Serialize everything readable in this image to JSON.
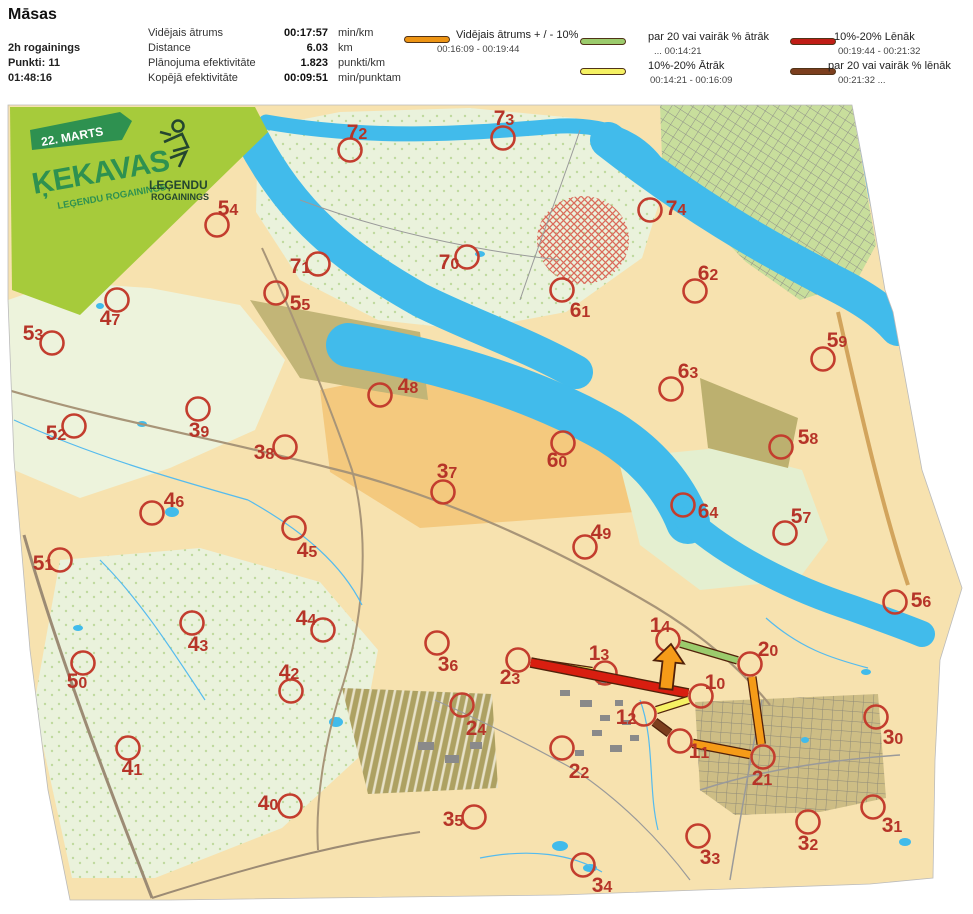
{
  "header": {
    "title": "Māsas",
    "event": "2h rogainings",
    "points": "Punkti: 11",
    "total_time": "01:48:16",
    "stats": {
      "rows": [
        {
          "label": "Vidējais ātrums",
          "value": "00:17:57",
          "unit": "min/km"
        },
        {
          "label": "Distance",
          "value": "6.03",
          "unit": "km"
        },
        {
          "label": "Plānojuma efektivitāte",
          "value": "1.823",
          "unit": "punkti/km"
        },
        {
          "label": "Kopējā efektivitāte",
          "value": "00:09:51",
          "unit": "min/punktam"
        }
      ]
    },
    "legend": {
      "entries": [
        {
          "label": "Vidējais ātrums + / - 10%",
          "range": "00:16:09   -   00:19:44",
          "color": "#ED9414"
        },
        {
          "label": "par 20 vai vairāk % ātrāk",
          "range": "...   00:14:21",
          "color": "#9BCB6C"
        },
        {
          "label": "10%-20% Ātrāk",
          "range": "00:14:21   -   00:16:09",
          "color": "#F5F163"
        },
        {
          "label": "10%-20% Lēnāk",
          "range": "00:19:44   - 00:21:32",
          "color": "#C01D16"
        },
        {
          "label": "par 20 vai vairāk % lēnāk",
          "range": "00:21:32   ...",
          "color": "#7C3E1E"
        }
      ]
    }
  },
  "banner": {
    "date": "22. MARTS",
    "title": "ĶEKAVAS",
    "subtitle": "LEĢENDU ROGAININGS",
    "logo_line1": "LEĢENDU",
    "logo_line2": "ROGAININGS",
    "bg_color": "#A6CB3B",
    "accent_color": "#2E9150",
    "logo_color": "#24462F"
  },
  "map": {
    "palette": {
      "red": "#D81E10",
      "yellow": "#F5F163",
      "orange": "#F59B18",
      "green": "#9BCB6C",
      "brown": "#7C3E1E",
      "outline": "#51210A",
      "water": "#41BBEB",
      "base": "#F7E2AF",
      "circle": "#C33D2E",
      "number": "#B63428"
    },
    "outline": "8,105 852,105 868,190 885,290 893,312 922,470 962,588 940,660 935,760 933,878 870,884 700,890 560,895 320,898 170,900 70,900 48,790 30,650 14,460 8,300",
    "regions": [
      {
        "name": "nw-green",
        "points": "8,300 60,282 150,288 240,305 285,360 255,430 170,468 80,498 14,470",
        "fill": "#EDF3DC"
      },
      {
        "name": "island",
        "points": "258,128 340,112 470,108 575,118 640,150 660,200 642,258 566,312 470,330 378,320 300,280 256,212",
        "fill": "url(#p-forest)"
      },
      {
        "name": "central-orange",
        "points": "320,390 470,360 560,388 615,425 650,470 635,512 530,520 420,528 330,472",
        "fill": "#F4C97E"
      },
      {
        "name": "sw-forest",
        "points": "60,560 200,548 320,582 378,650 358,758 282,828 155,878 72,878 34,705",
        "fill": "url(#p-forest)"
      },
      {
        "name": "se-green",
        "points": "618,458 718,448 802,470 828,540 798,580 700,590 640,545",
        "fill": "#E4EFD0"
      },
      {
        "name": "olive-1",
        "points": "250,300 420,332 428,400 300,378",
        "fill": "#C2B577"
      },
      {
        "name": "olive-2",
        "points": "700,378 798,418 788,468 708,448",
        "fill": "#BCB06F"
      },
      {
        "name": "industrial",
        "points": "342,688 492,694 498,788 368,794",
        "fill": "url(#p-indus)"
      },
      {
        "name": "residential-se",
        "points": "695,702 878,694 886,798 820,812 735,815 700,790",
        "fill": "url(#p-streets2)"
      },
      {
        "name": "peninsula",
        "points": "660,105 852,105 866,188 876,245 856,282 800,300 746,262 690,205 662,158",
        "fill": "url(#p-streets)"
      }
    ],
    "water_paths": [
      {
        "d": "M 252,138 C 292,214 342,256 420,300 C 472,326 522,342 576,372",
        "w": 34
      },
      {
        "d": "M 266,122 C 380,142 480,132 560,126 C 612,124 644,142 662,172",
        "w": 15
      },
      {
        "d": "M 608,140 C 690,204 762,246 832,282 C 864,298 884,312 898,328",
        "w": 36
      },
      {
        "d": "M 348,345 C 450,362 540,392 610,432 C 652,458 676,492 688,522",
        "w": 44
      },
      {
        "d": "M 688,520 C 728,556 790,588 852,608 C 880,618 902,626 922,634",
        "w": 26
      }
    ],
    "water_polys": [
      {
        "name": "water-topright",
        "points": "852,105 970,105 970,262 893,310 868,195"
      }
    ],
    "lakes": [
      [
        172,
        512,
        7,
        5
      ],
      [
        142,
        424,
        5,
        3
      ],
      [
        100,
        306,
        4,
        3
      ],
      [
        336,
        722,
        7,
        5
      ],
      [
        560,
        846,
        8,
        5
      ],
      [
        590,
        868,
        7,
        4
      ],
      [
        866,
        672,
        5,
        3
      ],
      [
        805,
        740,
        4,
        3
      ],
      [
        548,
        128,
        6,
        3
      ],
      [
        78,
        628,
        5,
        3
      ],
      [
        480,
        254,
        5,
        3
      ],
      [
        905,
        842,
        6,
        4
      ]
    ],
    "hatch_blob": {
      "cx": 583,
      "cy": 240,
      "rx": 46,
      "ry": 44
    },
    "roads": [
      {
        "d": "M 24,535 C 60,660 110,790 152,898",
        "s": "#9C8B74",
        "w": 3
      },
      {
        "d": "M 152,898 C 240,870 330,845 420,832",
        "s": "#9C8B74",
        "w": 2
      },
      {
        "d": "M 8,390 C 110,420 230,442 330,468 C 430,492 540,540 640,598 C 700,632 740,668 770,705",
        "s": "#A89578",
        "w": 2.2
      },
      {
        "d": "M 262,248 C 300,330 335,420 352,470 C 372,545 362,630 338,700 C 325,745 315,800 318,850",
        "s": "#A89578",
        "w": 2
      },
      {
        "d": "M 838,312 C 858,400 880,500 908,585",
        "s": "#D2A45C",
        "w": 4
      },
      {
        "d": "M 300,200 C 380,230 470,250 560,260",
        "s": "#9A9A9A",
        "w": 1
      },
      {
        "d": "M 580,130 C 560,190 540,240 520,300",
        "s": "#9A9A9A",
        "w": 1
      },
      {
        "d": "M 700,790 C 760,770 830,760 900,755",
        "s": "#9A9A9A",
        "w": 1.5
      },
      {
        "d": "M 762,700 C 750,760 740,820 730,880",
        "s": "#9A9A9A",
        "w": 1.5
      },
      {
        "d": "M 435,700 C 480,720 530,745 575,770",
        "s": "#9A9A9A",
        "w": 1.2
      },
      {
        "d": "M 575,770 C 620,800 660,840 690,880",
        "s": "#9A9A9A",
        "w": 1.2
      }
    ],
    "streams": [
      "M 14,420 C 90,455 170,478 248,500",
      "M 248,500 C 305,532 342,565 362,605",
      "M 640,700 C 655,740 648,790 658,830",
      "M 100,560 C 140,600 172,650 205,700",
      "M 480,858 C 530,848 572,854 602,872",
      "M 766,618 C 800,648 830,658 868,668"
    ],
    "buildings": [
      [
        560,
        690,
        10,
        6
      ],
      [
        580,
        700,
        12,
        7
      ],
      [
        600,
        715,
        10,
        6
      ],
      [
        615,
        700,
        8,
        6
      ],
      [
        592,
        730,
        10,
        6
      ],
      [
        610,
        745,
        12,
        7
      ],
      [
        575,
        750,
        9,
        6
      ],
      [
        630,
        735,
        9,
        6
      ],
      [
        598,
        680,
        8,
        5
      ],
      [
        622,
        720,
        9,
        5
      ],
      [
        418,
        742,
        16,
        8
      ],
      [
        445,
        755,
        14,
        8
      ],
      [
        470,
        742,
        12,
        7
      ]
    ],
    "banner_shape": {
      "body": "10,107 255,107 268,132 80,315 12,290",
      "flag": "30,130 120,112 132,121 122,140 32,150"
    },
    "controls": [
      {
        "id": "54",
        "c": [
          217,
          225
        ],
        "l": [
          228,
          208
        ]
      },
      {
        "id": "72",
        "c": [
          350,
          150
        ],
        "l": [
          357,
          132
        ]
      },
      {
        "id": "73",
        "c": [
          503,
          138
        ],
        "l": [
          504,
          118
        ]
      },
      {
        "id": "74",
        "c": [
          650,
          210
        ],
        "l": [
          676,
          208
        ]
      },
      {
        "id": "70",
        "c": [
          467,
          257
        ],
        "l": [
          449,
          262
        ]
      },
      {
        "id": "71",
        "c": [
          318,
          264
        ],
        "l": [
          300,
          266
        ]
      },
      {
        "id": "62",
        "c": [
          695,
          291
        ],
        "l": [
          708,
          273
        ]
      },
      {
        "id": "55",
        "c": [
          276,
          293
        ],
        "l": [
          300,
          303
        ]
      },
      {
        "id": "61",
        "c": [
          562,
          290
        ],
        "l": [
          580,
          310
        ]
      },
      {
        "id": "47",
        "c": [
          117,
          300
        ],
        "l": [
          110,
          318
        ]
      },
      {
        "id": "53",
        "c": [
          52,
          343
        ],
        "l": [
          33,
          333
        ]
      },
      {
        "id": "59",
        "c": [
          823,
          359
        ],
        "l": [
          837,
          340
        ]
      },
      {
        "id": "48",
        "c": [
          380,
          395
        ],
        "l": [
          408,
          386
        ]
      },
      {
        "id": "63",
        "c": [
          671,
          389
        ],
        "l": [
          688,
          371
        ]
      },
      {
        "id": "39",
        "c": [
          198,
          409
        ],
        "l": [
          199,
          430
        ]
      },
      {
        "id": "52",
        "c": [
          74,
          426
        ],
        "l": [
          56,
          433
        ]
      },
      {
        "id": "38",
        "c": [
          285,
          447
        ],
        "l": [
          264,
          452
        ]
      },
      {
        "id": "60",
        "c": [
          563,
          443
        ],
        "l": [
          557,
          460
        ]
      },
      {
        "id": "58",
        "c": [
          781,
          447
        ],
        "l": [
          808,
          437
        ]
      },
      {
        "id": "37",
        "c": [
          443,
          492
        ],
        "l": [
          447,
          471
        ]
      },
      {
        "id": "64",
        "c": [
          683,
          505
        ],
        "l": [
          708,
          511
        ]
      },
      {
        "id": "57",
        "c": [
          785,
          533
        ],
        "l": [
          801,
          516
        ]
      },
      {
        "id": "49",
        "c": [
          585,
          547
        ],
        "l": [
          601,
          532
        ]
      },
      {
        "id": "45",
        "c": [
          294,
          528
        ],
        "l": [
          307,
          550
        ]
      },
      {
        "id": "51",
        "c": [
          60,
          560
        ],
        "l": [
          43,
          563
        ]
      },
      {
        "id": "56",
        "c": [
          895,
          602
        ],
        "l": [
          921,
          600
        ]
      },
      {
        "id": "44",
        "c": [
          323,
          630
        ],
        "l": [
          306,
          618
        ]
      },
      {
        "id": "43",
        "c": [
          192,
          623
        ],
        "l": [
          198,
          644
        ]
      },
      {
        "id": "36",
        "c": [
          437,
          643
        ],
        "l": [
          448,
          664
        ]
      },
      {
        "id": "14",
        "c": [
          668,
          640
        ],
        "l": [
          660,
          625
        ]
      },
      {
        "id": "13",
        "c": [
          605,
          673
        ],
        "l": [
          599,
          653
        ]
      },
      {
        "id": "20",
        "c": [
          750,
          664
        ],
        "l": [
          768,
          649
        ]
      },
      {
        "id": "23",
        "c": [
          518,
          660
        ],
        "l": [
          510,
          677
        ]
      },
      {
        "id": "10",
        "c": [
          701,
          696
        ],
        "l": [
          715,
          682
        ]
      },
      {
        "id": "42",
        "c": [
          291,
          691
        ],
        "l": [
          289,
          672
        ]
      },
      {
        "id": "50",
        "c": [
          83,
          663
        ],
        "l": [
          77,
          681
        ]
      },
      {
        "id": "12",
        "c": [
          644,
          714
        ],
        "l": [
          626,
          717
        ]
      },
      {
        "id": "11",
        "c": [
          680,
          741
        ],
        "l": [
          699,
          751
        ]
      },
      {
        "id": "41",
        "c": [
          128,
          748
        ],
        "l": [
          132,
          768
        ]
      },
      {
        "id": "22",
        "c": [
          562,
          748
        ],
        "l": [
          579,
          771
        ]
      },
      {
        "id": "24",
        "c": [
          462,
          705
        ],
        "l": [
          476,
          728
        ]
      },
      {
        "id": "30",
        "c": [
          876,
          717
        ],
        "l": [
          893,
          737
        ]
      },
      {
        "id": "21",
        "c": [
          763,
          757
        ],
        "l": [
          762,
          778
        ]
      },
      {
        "id": "40",
        "c": [
          290,
          806
        ],
        "l": [
          268,
          803
        ]
      },
      {
        "id": "35",
        "c": [
          474,
          817
        ],
        "l": [
          453,
          819
        ]
      },
      {
        "id": "31",
        "c": [
          873,
          807
        ],
        "l": [
          892,
          825
        ]
      },
      {
        "id": "32",
        "c": [
          808,
          822
        ],
        "l": [
          808,
          843
        ]
      },
      {
        "id": "33",
        "c": [
          698,
          836
        ],
        "l": [
          710,
          857
        ]
      },
      {
        "id": "34",
        "c": [
          583,
          865
        ],
        "l": [
          602,
          885
        ]
      },
      {
        "id": "46",
        "c": [
          152,
          513
        ],
        "l": [
          174,
          500
        ]
      }
    ],
    "route": {
      "legs": [
        {
          "from": "13",
          "to": "23",
          "color": "yellow",
          "width": 6
        },
        {
          "from": "23",
          "to": "10",
          "color": "red",
          "width": 8
        },
        {
          "from": "10",
          "to": "12",
          "color": "yellow",
          "width": 6
        },
        {
          "from": "12",
          "to": "11",
          "color": "brown",
          "width": 7
        },
        {
          "from": "11",
          "to": "21",
          "color": "orange",
          "width": 7
        },
        {
          "from": "21",
          "to": "20",
          "color": "orange",
          "width": 7
        },
        {
          "from": "20",
          "to": "14",
          "color": "green",
          "width": 6
        }
      ],
      "finish_arrow": "659.5,688.3 662.5,661.3 654,660.3 671,644 684,663.6 675.5,662.7 672.5,689.7"
    }
  }
}
